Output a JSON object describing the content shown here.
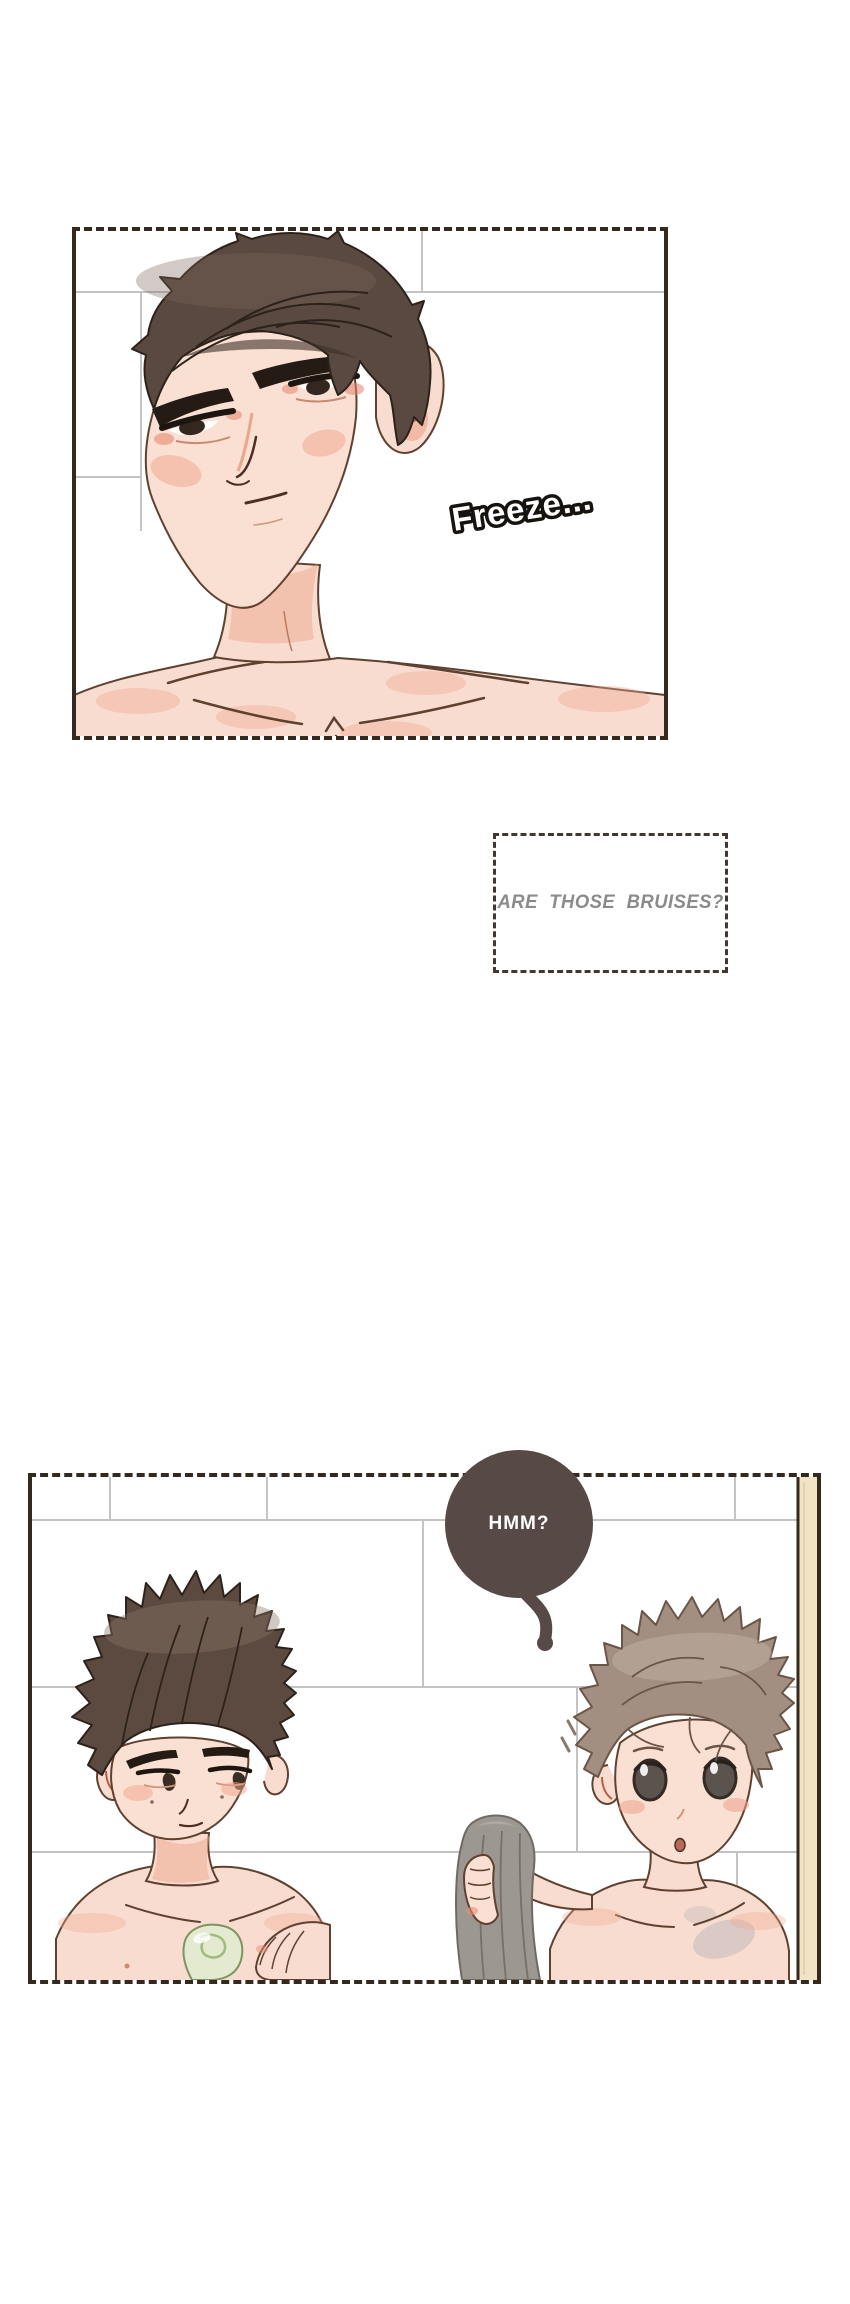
{
  "page": {
    "width": 850,
    "height": 2304,
    "background": "#ffffff"
  },
  "panel1": {
    "sfx": "Freeze...",
    "border_color": "#33291f"
  },
  "narration_box": {
    "text": "ARE THOSE BRUISES?",
    "text_color": "#8b8b8b",
    "border_color": "#443630"
  },
  "panel2": {
    "bubble": {
      "text": "HMM?",
      "bg": "#574945",
      "text_color": "#ffffff"
    }
  },
  "palette": {
    "skin": "#f9dcd0",
    "blush": "#efa78c",
    "outline": "#5f4130",
    "hair_dark_brown": "#5a4941",
    "hair_light_brown": "#a38f81",
    "towel_gray": "#9d9791",
    "soap_green": "#e3ead0",
    "tile_grout": "#c3c3c3",
    "wall_trim_beige": "#f3e3c5",
    "bruise": "#97a1aa"
  }
}
